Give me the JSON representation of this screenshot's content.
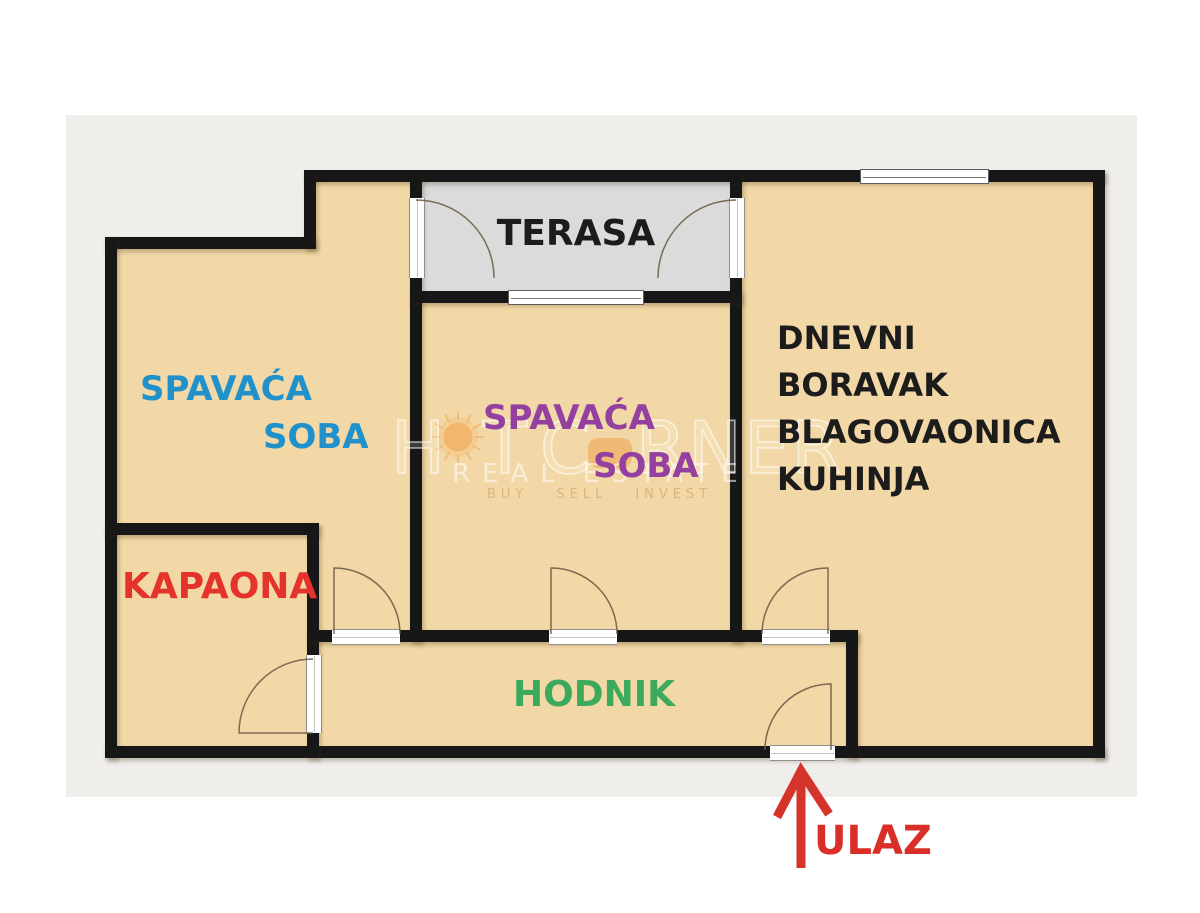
{
  "floorplan": {
    "labels": {
      "terasa": "TERASA",
      "bedroom_left": {
        "line1": "SPAVAĆA",
        "line2": "SOBA"
      },
      "bedroom_mid": {
        "line1": "SPAVAĆA",
        "line2": "SOBA"
      },
      "living": {
        "lines": [
          "DNEVNI",
          "BORAVAK",
          "BLAGOVAONICA",
          "KUHINJA"
        ]
      },
      "kapaona": "KAPAONA",
      "hodnik": "HODNIK",
      "ulaz": "ULAZ"
    },
    "colors": {
      "floor": "#f2d8a6",
      "wall": "#171717",
      "terrace_floor": "#dbdbdb",
      "mat_background": "#f0eeea",
      "page_background": "#ffffff",
      "bedroom_left_label": "#2191cc",
      "bedroom_mid_label": "#9340a0",
      "kapaona_label": "#e3332a",
      "hodnik_label": "#3ca95c",
      "ulaz_label": "#d92f28",
      "black_label": "#1c1c1c",
      "entrance_arrow": "#d5342b",
      "door_arc": "#6e5f47"
    }
  },
  "watermark": {
    "brand_part1": "H",
    "brand_part2": "T",
    "brand_part3": "C",
    "brand_part4": "RNER",
    "tagline_word1": "REAL",
    "tagline_word2": "ESTATE",
    "motto_word1": "BUY",
    "motto_word2": "SELL",
    "motto_word3": "INVEST",
    "sun_color": "#f2ab59"
  }
}
